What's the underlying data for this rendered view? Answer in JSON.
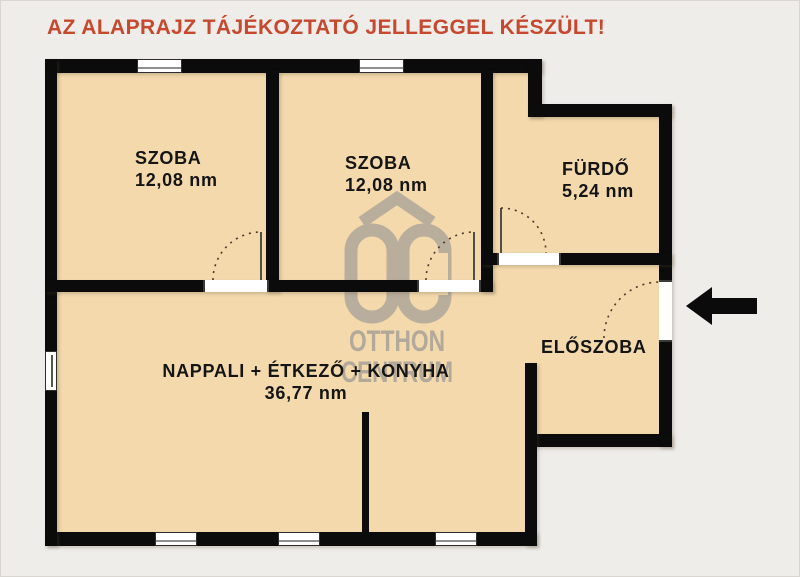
{
  "disclaimer": {
    "text": "AZ ALAPRAJZ TÁJÉKOZTATÓ JELLEGGEL KÉSZÜLT!",
    "color": "#c6492f"
  },
  "rooms": {
    "szoba1": {
      "name": "SZOBA",
      "area": "12,08 nm"
    },
    "szoba2": {
      "name": "SZOBA",
      "area": "12,08 nm"
    },
    "furdo": {
      "name": "FÜRDŐ",
      "area": "5,24 nm"
    },
    "eloszoba": {
      "name": "ELŐSZOBA"
    },
    "nappali": {
      "name": "NAPPALI + ÉTKEZŐ + KONYHA",
      "area": "36,77 nm"
    }
  },
  "watermark": {
    "line1": "OTTHON",
    "line2": "CENTRUM",
    "color": "#b3a99b"
  },
  "colors": {
    "page_background": "#efedea",
    "floor": "#f3d9ac",
    "wall": "#0b0b0b",
    "title_red": "#c6492f"
  },
  "icons": {
    "entrance_arrow": "left-arrow-icon",
    "doors": "quarter-arc-door-swing",
    "logo": "otthon-centrum-roof-oc"
  }
}
